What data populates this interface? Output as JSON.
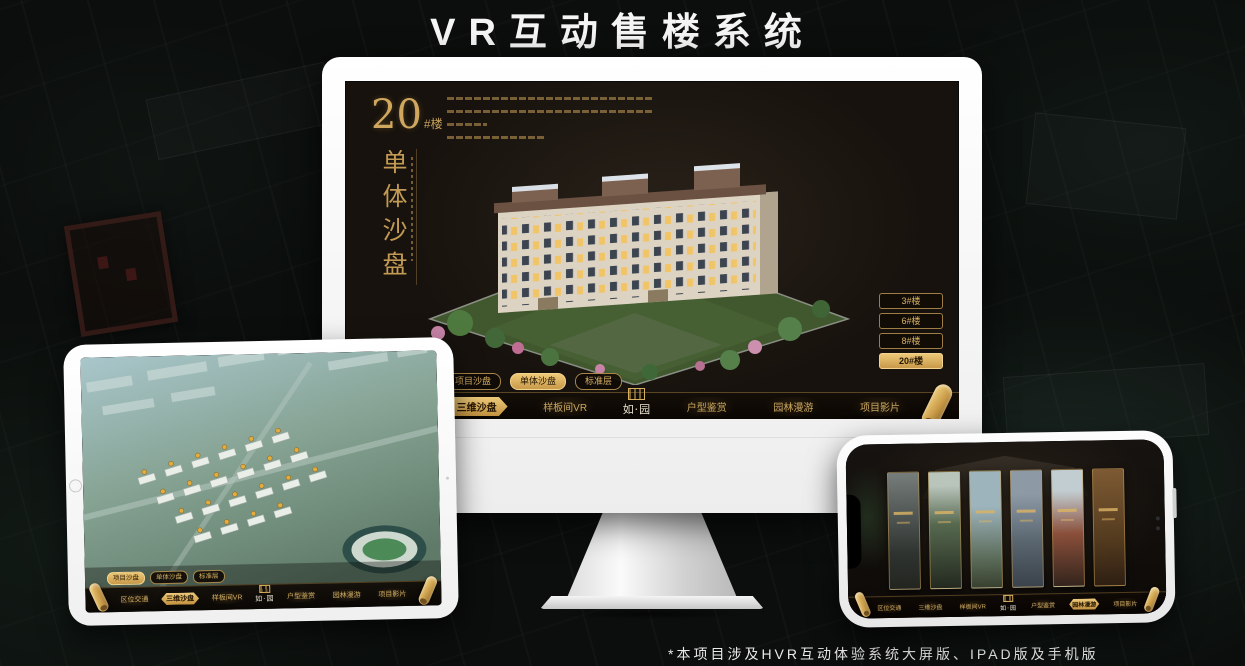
{
  "page": {
    "title": "VR互动售楼系统",
    "footnote": "*本项目涉及HVR互动体验系统大屏版、IPAD版及手机版"
  },
  "colors": {
    "gold": "#c9a35c",
    "gold_active": "#e3bd6b",
    "screen_bg": "#17120d",
    "monitor_frame": "#ffffff"
  },
  "desktop_screen": {
    "headline": {
      "number": "20",
      "suffix": "#楼",
      "vertical": "单体沙盘"
    },
    "floor_buttons": [
      "3#楼",
      "6#楼",
      "8#楼",
      "20#楼"
    ],
    "active_floor": "20#楼"
  },
  "sub_tabs": [
    "项目沙盘",
    "单体沙盘",
    "标准层"
  ],
  "nav": {
    "logo": "如·园",
    "items": [
      "区位交通",
      "三维沙盘",
      "样板间VR",
      "户型鉴赏",
      "园林漫游",
      "项目影片"
    ]
  }
}
